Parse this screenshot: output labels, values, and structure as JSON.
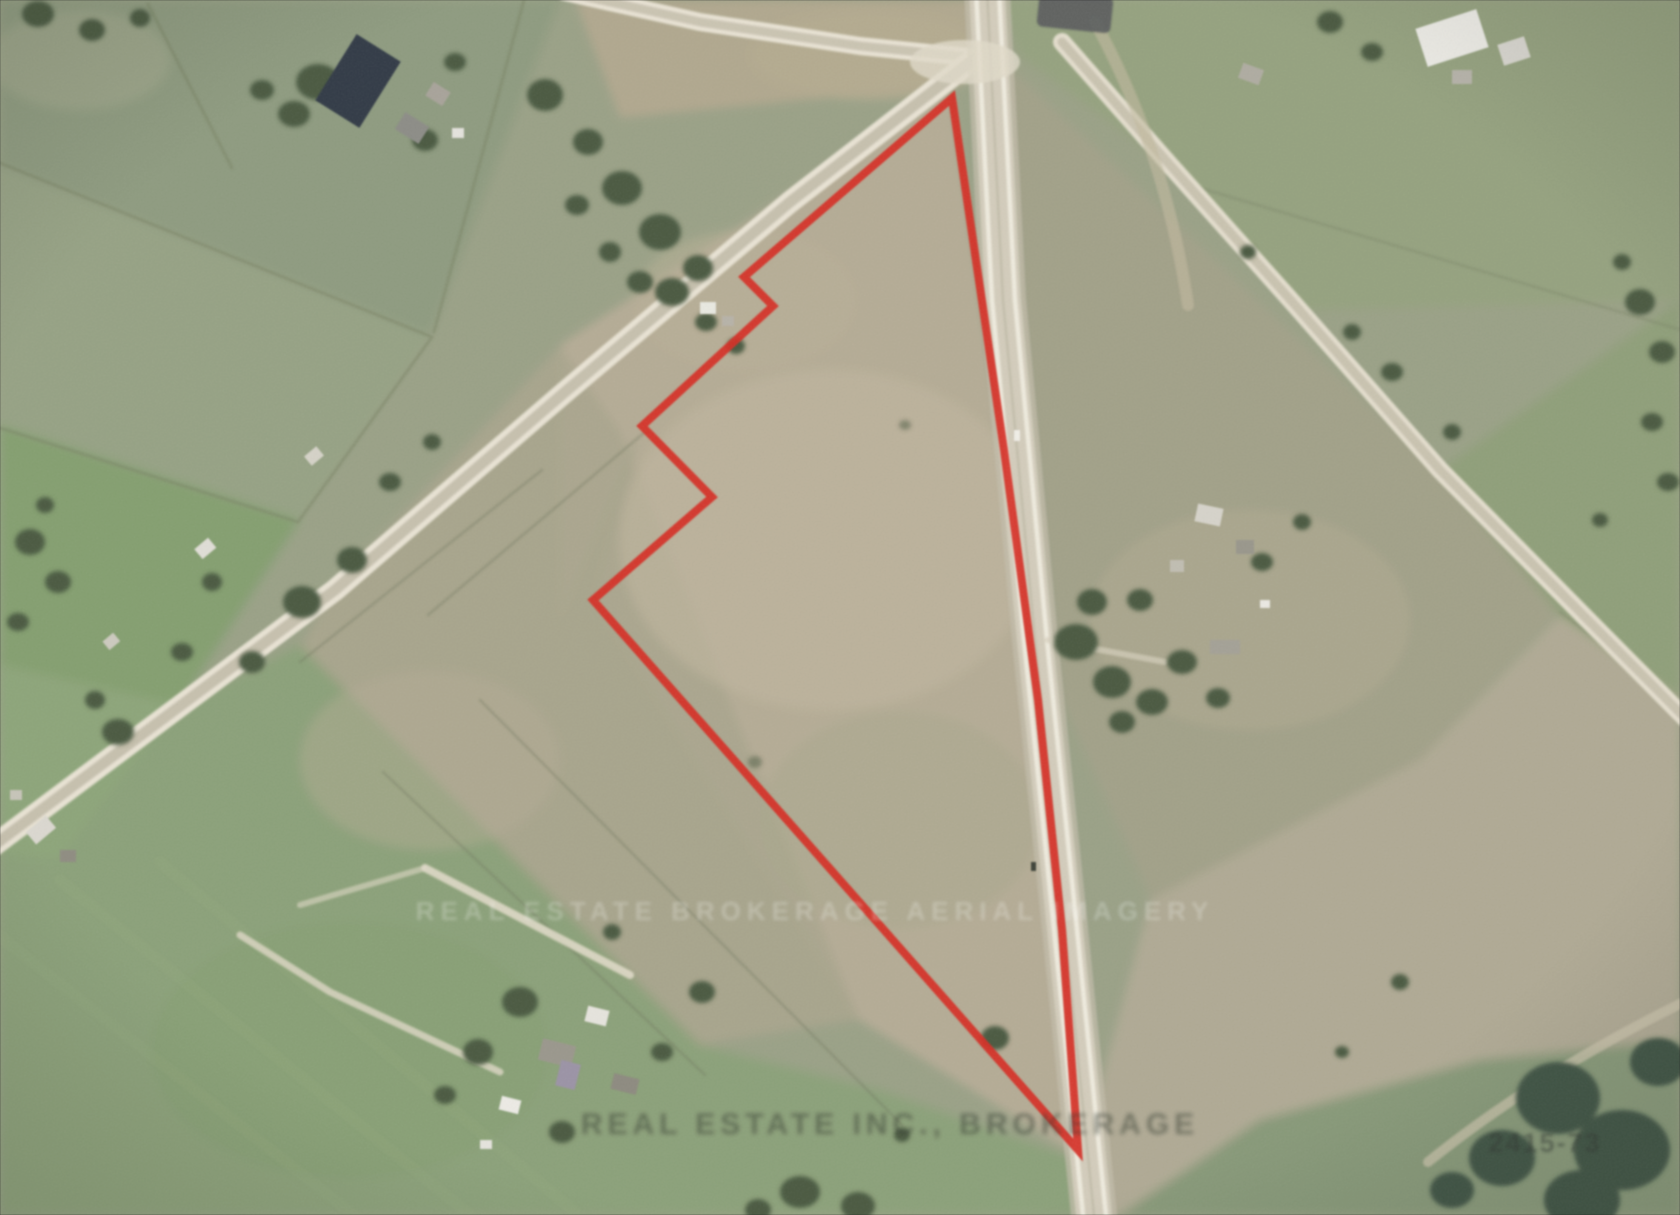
{
  "image": {
    "type_label": "aerial-property-photo",
    "width_px": 1680,
    "height_px": 1215
  },
  "boundary": {
    "color": "#e0261c",
    "points": "952,98 1004,450 1038,700 1062,930 1078,1150 593,600 712,497 642,426 773,306 744,277"
  },
  "watermarks": {
    "middle": "REAL ESTATE BROKERAGE AERIAL IMAGERY",
    "bottom": "REAL ESTATE INC., BROKERAGE",
    "corner_code": "2415-73"
  },
  "palette": {
    "field_green": "#8e9c7e",
    "field_bright_green": "#83a06d",
    "field_tan": "#b7ad94",
    "road_light": "#ece6d6",
    "road_mid": "#c9c2ae",
    "tree_dark": "#46583e",
    "boundary_red": "#e0261c"
  }
}
